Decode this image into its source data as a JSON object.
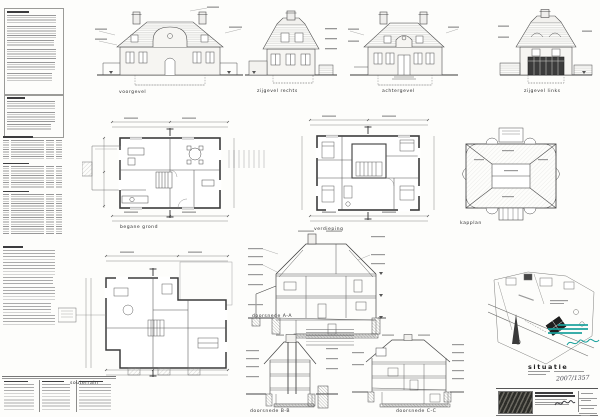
{
  "labels": {
    "elevations": [
      "voorgevel",
      "zijgevel rechts",
      "achtergevel",
      "zijgevel links"
    ],
    "plan_ground": "begane grond",
    "plan_first": "verdieping",
    "plan_roof": "kapplan",
    "plan_basement": "souterrain",
    "section_a": "doorsnede A-A",
    "section_b": "doorsnede B-B",
    "section_c": "doorsnede C-C",
    "site_title": "situatie",
    "dossier_number": "2007/1357"
  },
  "colors": {
    "ink": "#4a4a4a",
    "heavy_wall": "#333333",
    "stamp_teal": "#17a09b",
    "paper": "#fdfdfb",
    "conservatory_glass": "#3c3c3c"
  }
}
